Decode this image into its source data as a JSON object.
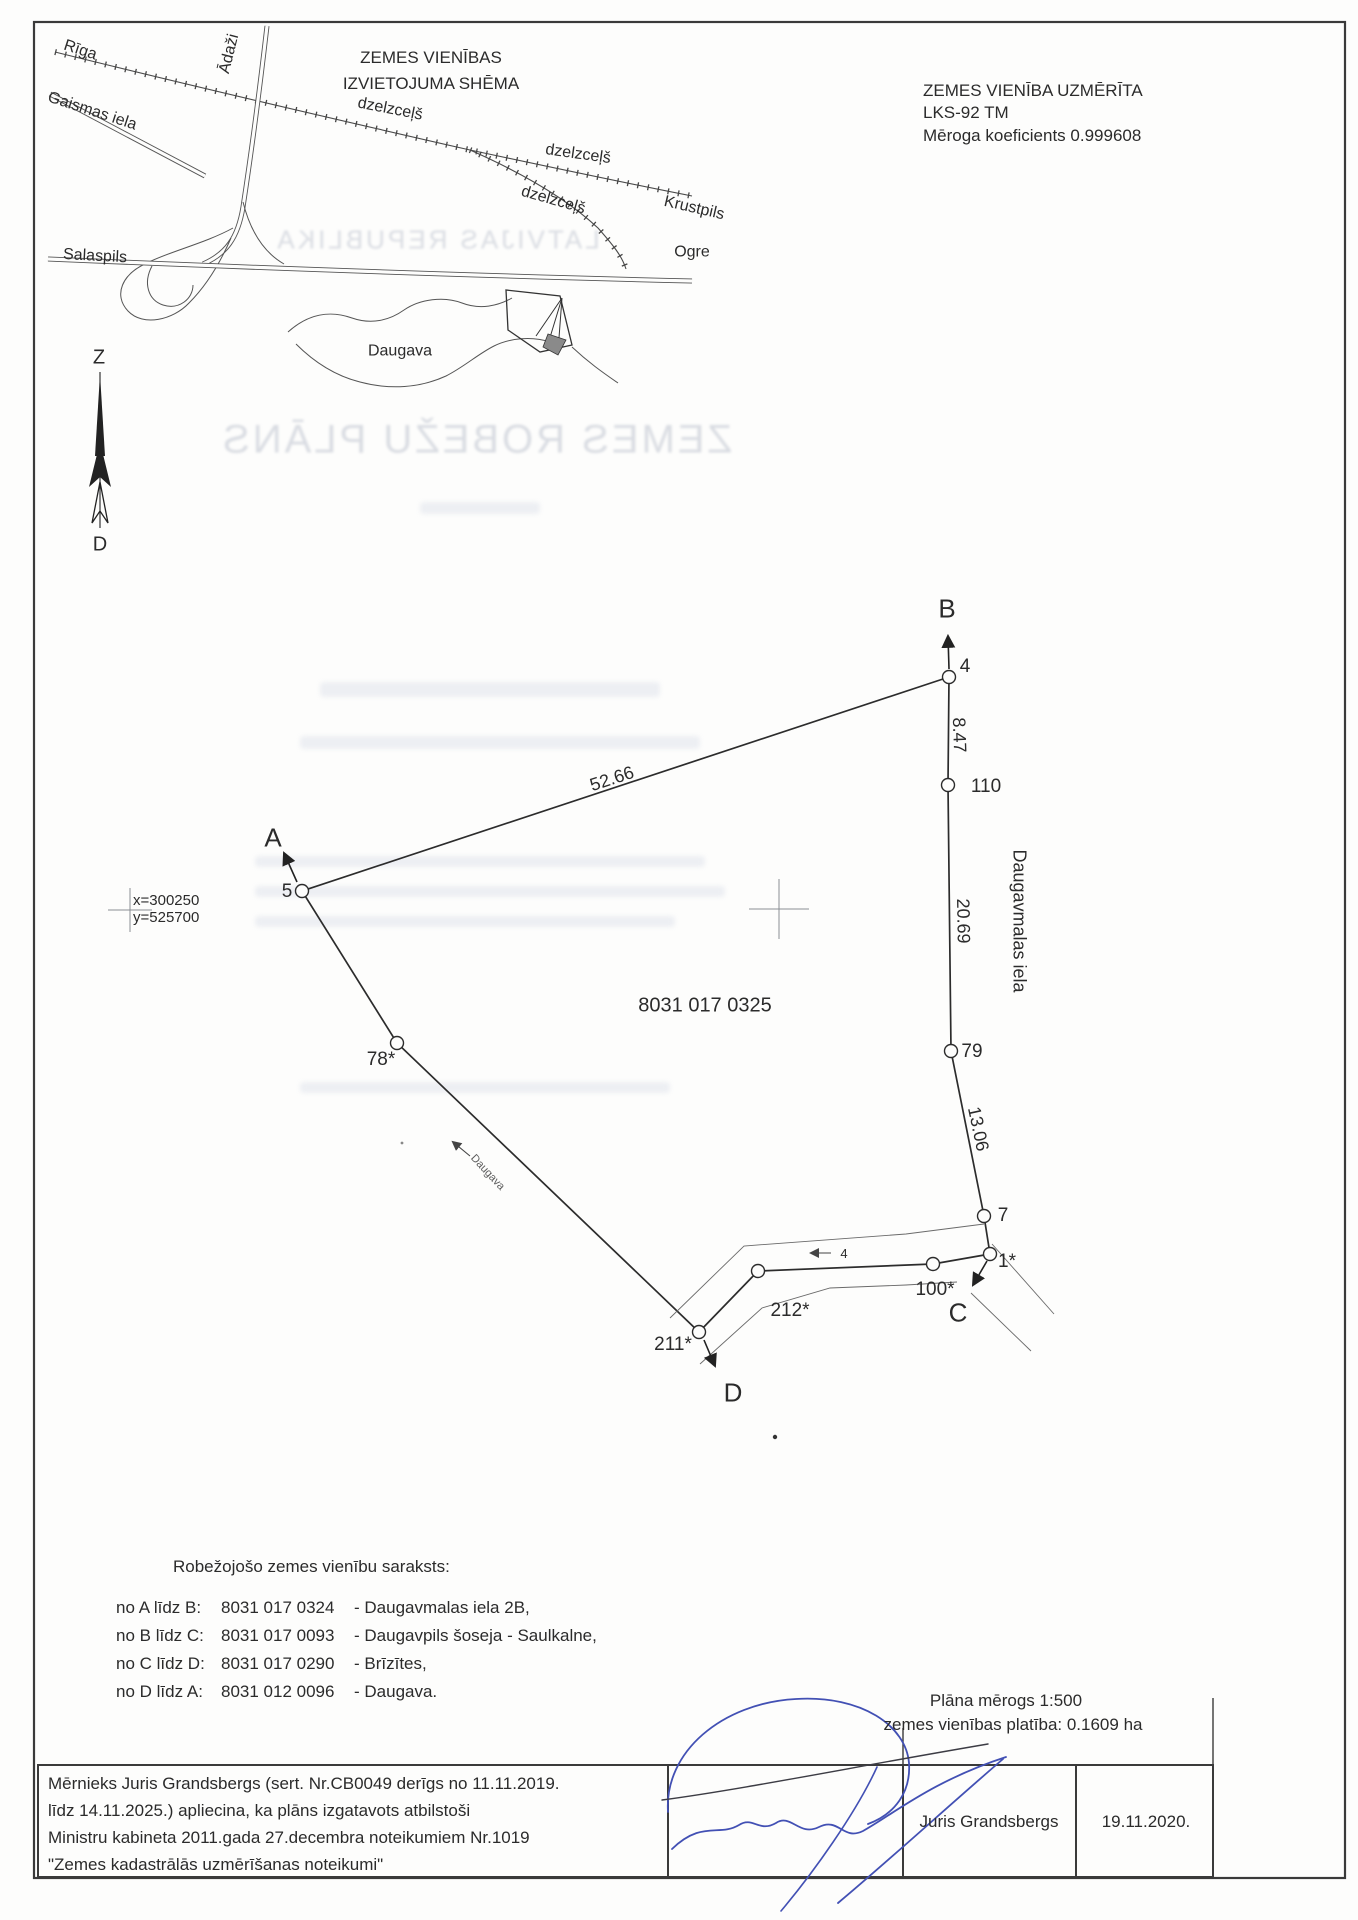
{
  "schema_map": {
    "title1": "ZEMES VIENĪBAS",
    "title2": "IZVIETOJUMA SHĒMA",
    "riga": "Rīga",
    "adazi": "Ādaži",
    "gaismas_iela": "Gaismas iela",
    "dzelzcels1": "dzelzceļš",
    "dzelzcels2": "dzelzceļš",
    "dzelzcels3": "dzelzceļš",
    "krustpils": "Krustpils",
    "ogre": "Ogre",
    "salaspils": "Salaspils",
    "daugava": "Daugava"
  },
  "survey_info": {
    "line1": "ZEMES VIENĪBA UZMĒRĪTA",
    "line2": "LKS-92 TM",
    "line3": "Mēroga koeficients 0.999608"
  },
  "north_arrow": {
    "north": "Z",
    "south": "D"
  },
  "bleedthrough": {
    "line1": "LATVIJAS REPUBLIKA",
    "line2": "ZEMES ROBEŽU PLĀNS"
  },
  "plan": {
    "parcel_code": "8031 017 0325",
    "grid_x": "x=300250",
    "grid_y": "y=525700",
    "corner_a": "A",
    "corner_b": "B",
    "corner_c": "C",
    "corner_d": "D",
    "v4": "4",
    "v5": "5",
    "v110": "110",
    "v79": "79",
    "v7": "7",
    "v1": "1*",
    "v100": "100*",
    "v212": "212*",
    "v211": "211*",
    "v78": "78*",
    "d_ab": "52.66",
    "d_4_110": "8.47",
    "d_110_79": "20.69",
    "d_79_7": "13.06",
    "street": "Daugavmalas iela",
    "river": "Daugava",
    "road_marker": "4"
  },
  "border_list": {
    "heading": "Robežojošo zemes vienību saraksts:",
    "rows": [
      {
        "from_to": "no A līdz B:",
        "code": "8031 017 0324",
        "name": "- Daugavmalas iela 2B,"
      },
      {
        "from_to": "no B līdz C:",
        "code": "8031 017 0093",
        "name": "- Daugavpils šoseja - Saulkalne,"
      },
      {
        "from_to": "no C līdz D:",
        "code": "8031 017 0290",
        "name": "- Brīzītes,"
      },
      {
        "from_to": "no D līdz A:",
        "code": "8031 012 0096",
        "name": "- Daugava."
      }
    ]
  },
  "scale_info": {
    "line1": "Plāna mērogs 1:500",
    "line2": "zemes vienības platība: 0.1609 ha"
  },
  "footer": {
    "statement_lines": [
      "Mērnieks Juris Grandsbergs (sert. Nr.CB0049 derīgs no 11.11.2019.",
      "līdz 14.11.2025.) apliecina, ka plāns izgatavots atbilstoši",
      "Ministru kabineta 2011.gada 27.decembra noteikumiem Nr.1019",
      "\"Zemes kadastrālās uzmērīšanas noteikumi\""
    ],
    "surveyor_name": "Juris Grandsbergs",
    "date": "19.11.2020."
  }
}
